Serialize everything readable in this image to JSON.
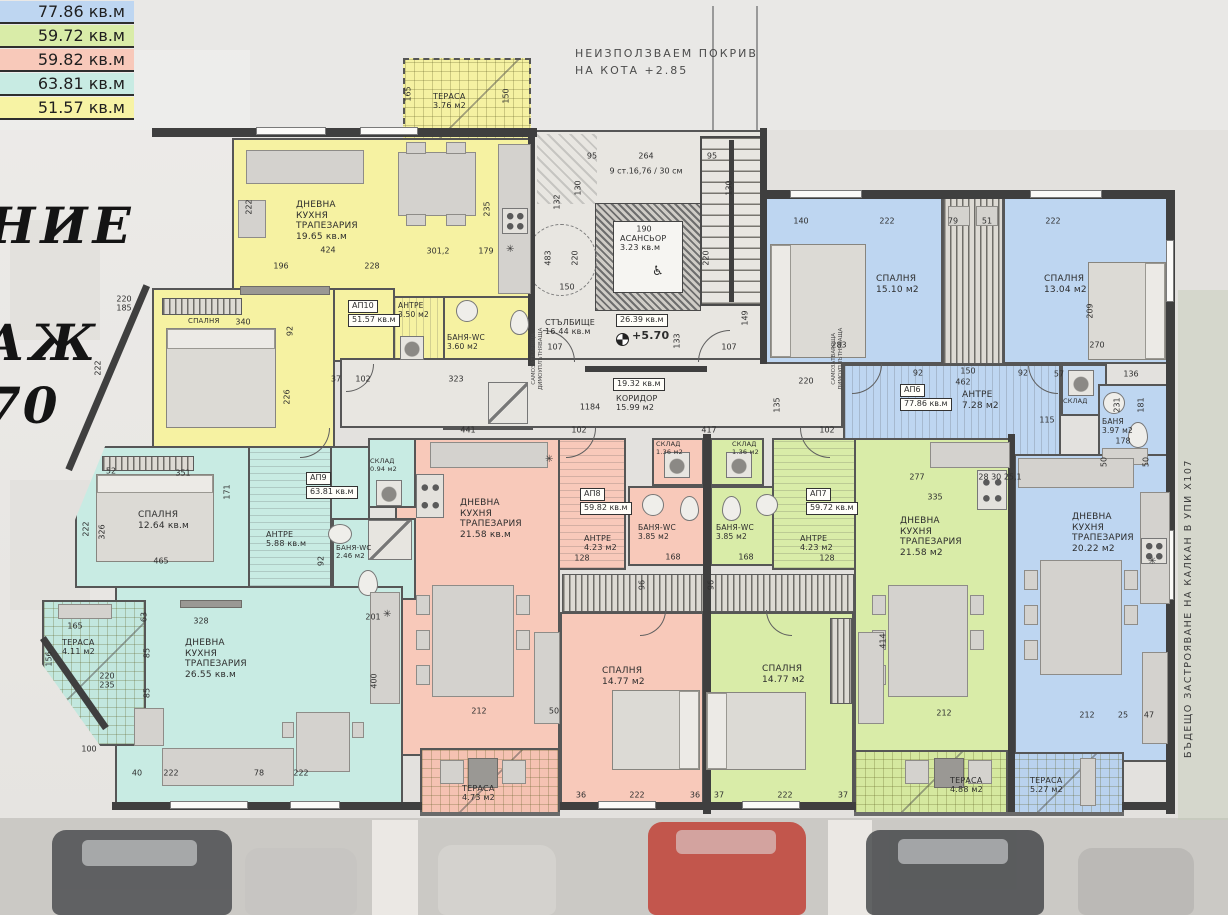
{
  "legend": {
    "items": [
      {
        "area": "77.86 кв.м",
        "color": "#bed6f1"
      },
      {
        "area": "59.72 кв.м",
        "color": "#d9eca8"
      },
      {
        "area": "59.82 кв.м",
        "color": "#f8c9ba"
      },
      {
        "area": "63.81 кв.м",
        "color": "#c8ebe3"
      },
      {
        "area": "51.57 кв.м",
        "color": "#f7f3a4"
      }
    ]
  },
  "notes": {
    "roof": "НЕИЗПОЛЗВАЕМ ПОКРИВ\nНА КОТА +2.85",
    "handwriting_1": "НИЕ",
    "handwriting_2": "АЖ",
    "handwriting_3": "70",
    "future_building": "БЪДЕЩО ЗАСТРОЯВАНЕ НА КАЛКАН В УПИ X107"
  },
  "symbols": {
    "cooktop": "✳",
    "wheelchair": "♿"
  },
  "core": {
    "elevator": {
      "name": "АСАНСЬОР",
      "area": "3.23 кв.м"
    },
    "staircase": {
      "name": "СТЪЛБИЩЕ",
      "area": "16.44 кв.м"
    },
    "stair_total_box": "26.39 кв.м",
    "level_mark": "+5.70",
    "level_dim": "289",
    "corridor_box": "19.32 кв.м",
    "corridor": {
      "name": "КОРИДОР",
      "area": "15.99 м2"
    },
    "door_note": "САМОЗАТВАРЯЩА\nДИМОУПЛЪТНЯВАЩА"
  },
  "apartments": {
    "ap10": {
      "id": "АП10",
      "total": "51.57 кв.м",
      "color": "#f6f2a2",
      "living": {
        "name": "ДНЕВНА\nКУХНЯ\nТРАПЕЗАРИЯ",
        "area": "19.65 кв.м"
      },
      "bedroom": {
        "name": "СПАЛНЯ",
        "area": ""
      },
      "antre": {
        "name": "АНТРЕ",
        "area": "3.50 м2"
      },
      "bath": {
        "name": "БАНЯ-WC",
        "area": "3.60 м2"
      },
      "terrace": {
        "name": "ТЕРАСА",
        "area": "3.76 м2"
      }
    },
    "ap9": {
      "id": "АП9",
      "total": "63.81 кв.м",
      "color": "#c8ebe3",
      "living": {
        "name": "ДНЕВНА\nКУХНЯ\nТРАПЕЗАРИЯ",
        "area": "26.55 кв.м"
      },
      "bedroom": {
        "name": "СПАЛНЯ",
        "area": "12.64 кв.м"
      },
      "antre": {
        "name": "АНТРЕ",
        "area": "5.88 кв.м"
      },
      "bath": {
        "name": "БАНЯ-WC",
        "area": "2.46 м2"
      },
      "sklad": {
        "name": "СКЛАД",
        "area": "0.94 м2"
      },
      "terrace": {
        "name": "ТЕРАСА",
        "area": "4.11 м2"
      }
    },
    "ap8": {
      "id": "АП8",
      "total": "59.82 кв.м",
      "color": "#f8c9ba",
      "living": {
        "name": "ДНЕВНА\nКУХНЯ\nТРАПЕЗАРИЯ",
        "area": "21.58 кв.м"
      },
      "bedroom": {
        "name": "СПАЛНЯ",
        "area": "14.77 м2"
      },
      "antre": {
        "name": "АНТРЕ",
        "area": "4.23 м2"
      },
      "bath": {
        "name": "БАНЯ-WC",
        "area": "3.85 м2"
      },
      "sklad": {
        "name": "СКЛАД",
        "area": "1.36 м2"
      },
      "terrace": {
        "name": "ТЕРАСА",
        "area": "4.73 м2"
      }
    },
    "ap7": {
      "id": "АП7",
      "total": "59.72 кв.м",
      "color": "#d9eca8",
      "living": {
        "name": "ДНЕВНА\nКУХНЯ\nТРАПЕЗАРИЯ",
        "area": "21.58 м2"
      },
      "bedroom": {
        "name": "СПАЛНЯ",
        "area": "14.77 м2"
      },
      "antre": {
        "name": "АНТРЕ",
        "area": "4.23 м2"
      },
      "bath": {
        "name": "БАНЯ-WC",
        "area": "3.85 м2"
      },
      "sklad": {
        "name": "СКЛАД",
        "area": "1.36 м2"
      },
      "terrace": {
        "name": "ТЕРАСА",
        "area": "4.88 м2"
      }
    },
    "ap6": {
      "id": "АП6",
      "total": "77.86 кв.м",
      "color": "#bed6f1",
      "living": {
        "name": "ДНЕВНА\nКУХНЯ\nТРАПЕЗАРИЯ",
        "area": "20.22 м2"
      },
      "bedroom1": {
        "name": "СПАЛНЯ",
        "area": "15.10 м2"
      },
      "bedroom2": {
        "name": "СПАЛНЯ",
        "area": "13.04 м2"
      },
      "antre": {
        "name": "АНТРЕ",
        "area": "7.28 м2"
      },
      "bath": {
        "name": "БАНЯ",
        "area": "3.97 м2"
      },
      "sklad": {
        "name": "СКЛАД",
        "area": ""
      },
      "terrace": {
        "name": "ТЕРАСА",
        "area": "5.27 м2"
      }
    }
  },
  "dimensions": [
    {
      "t": "95",
      "x": 592,
      "y": 156
    },
    {
      "t": "264",
      "x": 646,
      "y": 156
    },
    {
      "t": "95",
      "x": 712,
      "y": 156
    },
    {
      "t": "130",
      "x": 578,
      "y": 188,
      "v": 1
    },
    {
      "t": "132",
      "x": 557,
      "y": 202,
      "v": 1
    },
    {
      "t": "130",
      "x": 729,
      "y": 188,
      "v": 1
    },
    {
      "t": "9 ст.16,76 / 30 см",
      "x": 646,
      "y": 171
    },
    {
      "t": "150",
      "x": 506,
      "y": 96,
      "v": 1
    },
    {
      "t": "165",
      "x": 408,
      "y": 94,
      "v": 1
    },
    {
      "t": "424",
      "x": 328,
      "y": 250
    },
    {
      "t": "196",
      "x": 281,
      "y": 266
    },
    {
      "t": "228",
      "x": 372,
      "y": 266
    },
    {
      "t": "301,2",
      "x": 438,
      "y": 251
    },
    {
      "t": "179",
      "x": 486,
      "y": 251
    },
    {
      "t": "222",
      "x": 249,
      "y": 207,
      "v": 1
    },
    {
      "t": "235",
      "x": 487,
      "y": 209,
      "v": 1
    },
    {
      "t": "340",
      "x": 243,
      "y": 322
    },
    {
      "t": "92",
      "x": 290,
      "y": 331,
      "v": 1
    },
    {
      "t": "222",
      "x": 98,
      "y": 368,
      "v": 1
    },
    {
      "t": "226",
      "x": 287,
      "y": 397,
      "v": 1
    },
    {
      "t": "220",
      "x": 124,
      "y": 299
    },
    {
      "t": "185",
      "x": 124,
      "y": 308
    },
    {
      "t": "37",
      "x": 336,
      "y": 379
    },
    {
      "t": "102",
      "x": 363,
      "y": 379
    },
    {
      "t": "323",
      "x": 456,
      "y": 379
    },
    {
      "t": "190",
      "x": 644,
      "y": 229
    },
    {
      "t": "483",
      "x": 548,
      "y": 258,
      "v": 1
    },
    {
      "t": "220",
      "x": 575,
      "y": 258,
      "v": 1
    },
    {
      "t": "150",
      "x": 567,
      "y": 287
    },
    {
      "t": "220",
      "x": 706,
      "y": 258,
      "v": 1
    },
    {
      "t": "149",
      "x": 745,
      "y": 318,
      "v": 1
    },
    {
      "t": "133",
      "x": 677,
      "y": 341,
      "v": 1
    },
    {
      "t": "107",
      "x": 555,
      "y": 347
    },
    {
      "t": "107",
      "x": 729,
      "y": 347
    },
    {
      "t": "1184",
      "x": 590,
      "y": 407
    },
    {
      "t": "441",
      "x": 468,
      "y": 430
    },
    {
      "t": "102",
      "x": 579,
      "y": 430
    },
    {
      "t": "417",
      "x": 709,
      "y": 430
    },
    {
      "t": "102",
      "x": 827,
      "y": 430
    },
    {
      "t": "140",
      "x": 801,
      "y": 221
    },
    {
      "t": "222",
      "x": 887,
      "y": 221
    },
    {
      "t": "79",
      "x": 953,
      "y": 221
    },
    {
      "t": "51",
      "x": 987,
      "y": 221
    },
    {
      "t": "222",
      "x": 1053,
      "y": 221
    },
    {
      "t": "283",
      "x": 839,
      "y": 345
    },
    {
      "t": "220",
      "x": 806,
      "y": 381
    },
    {
      "t": "135",
      "x": 777,
      "y": 405,
      "v": 1
    },
    {
      "t": "92",
      "x": 918,
      "y": 373
    },
    {
      "t": "150",
      "x": 968,
      "y": 371
    },
    {
      "t": "462",
      "x": 963,
      "y": 382
    },
    {
      "t": "92",
      "x": 1023,
      "y": 373
    },
    {
      "t": "115",
      "x": 1047,
      "y": 420
    },
    {
      "t": "57",
      "x": 1059,
      "y": 374
    },
    {
      "t": "270",
      "x": 1097,
      "y": 345
    },
    {
      "t": "209",
      "x": 1090,
      "y": 311,
      "v": 1
    },
    {
      "t": "136",
      "x": 1131,
      "y": 374
    },
    {
      "t": "231",
      "x": 1117,
      "y": 405,
      "v": 1
    },
    {
      "t": "181",
      "x": 1141,
      "y": 405,
      "v": 1
    },
    {
      "t": "178",
      "x": 1123,
      "y": 441
    },
    {
      "t": "50",
      "x": 1104,
      "y": 462,
      "v": 1
    },
    {
      "t": "50",
      "x": 1146,
      "y": 462,
      "v": 1
    },
    {
      "t": "277",
      "x": 917,
      "y": 477
    },
    {
      "t": "335",
      "x": 935,
      "y": 497
    },
    {
      "t": "28 30 25,1",
      "x": 1000,
      "y": 477
    },
    {
      "t": "351",
      "x": 183,
      "y": 473
    },
    {
      "t": "52",
      "x": 111,
      "y": 471
    },
    {
      "t": "171",
      "x": 227,
      "y": 492,
      "v": 1
    },
    {
      "t": "222",
      "x": 86,
      "y": 529,
      "v": 1
    },
    {
      "t": "326",
      "x": 102,
      "y": 532,
      "v": 1
    },
    {
      "t": "465",
      "x": 161,
      "y": 561
    },
    {
      "t": "92",
      "x": 321,
      "y": 561,
      "v": 1
    },
    {
      "t": "168",
      "x": 673,
      "y": 557
    },
    {
      "t": "168",
      "x": 746,
      "y": 557
    },
    {
      "t": "128",
      "x": 582,
      "y": 558
    },
    {
      "t": "128",
      "x": 827,
      "y": 558
    },
    {
      "t": "96",
      "x": 642,
      "y": 585,
      "v": 1
    },
    {
      "t": "96",
      "x": 711,
      "y": 585,
      "v": 1
    },
    {
      "t": "201",
      "x": 373,
      "y": 617
    },
    {
      "t": "400",
      "x": 374,
      "y": 681,
      "v": 1
    },
    {
      "t": "328",
      "x": 201,
      "y": 621
    },
    {
      "t": "63",
      "x": 144,
      "y": 617,
      "v": 1
    },
    {
      "t": "85",
      "x": 147,
      "y": 653,
      "v": 1
    },
    {
      "t": "85",
      "x": 147,
      "y": 693,
      "v": 1
    },
    {
      "t": "220",
      "x": 107,
      "y": 676
    },
    {
      "t": "235",
      "x": 107,
      "y": 685
    },
    {
      "t": "165",
      "x": 75,
      "y": 626
    },
    {
      "t": "156",
      "x": 49,
      "y": 659,
      "v": 1
    },
    {
      "t": "100",
      "x": 89,
      "y": 749
    },
    {
      "t": "40",
      "x": 137,
      "y": 773
    },
    {
      "t": "222",
      "x": 171,
      "y": 773
    },
    {
      "t": "78",
      "x": 259,
      "y": 773
    },
    {
      "t": "222",
      "x": 301,
      "y": 773
    },
    {
      "t": "212",
      "x": 479,
      "y": 711
    },
    {
      "t": "50",
      "x": 554,
      "y": 711
    },
    {
      "t": "212",
      "x": 944,
      "y": 713
    },
    {
      "t": "414",
      "x": 883,
      "y": 641,
      "v": 1
    },
    {
      "t": "212",
      "x": 1087,
      "y": 715
    },
    {
      "t": "25",
      "x": 1123,
      "y": 715
    },
    {
      "t": "47",
      "x": 1149,
      "y": 715
    },
    {
      "t": "36",
      "x": 581,
      "y": 795
    },
    {
      "t": "222",
      "x": 637,
      "y": 795
    },
    {
      "t": "36",
      "x": 695,
      "y": 795
    },
    {
      "t": "37",
      "x": 719,
      "y": 795
    },
    {
      "t": "222",
      "x": 785,
      "y": 795
    },
    {
      "t": "37",
      "x": 843,
      "y": 795
    }
  ]
}
